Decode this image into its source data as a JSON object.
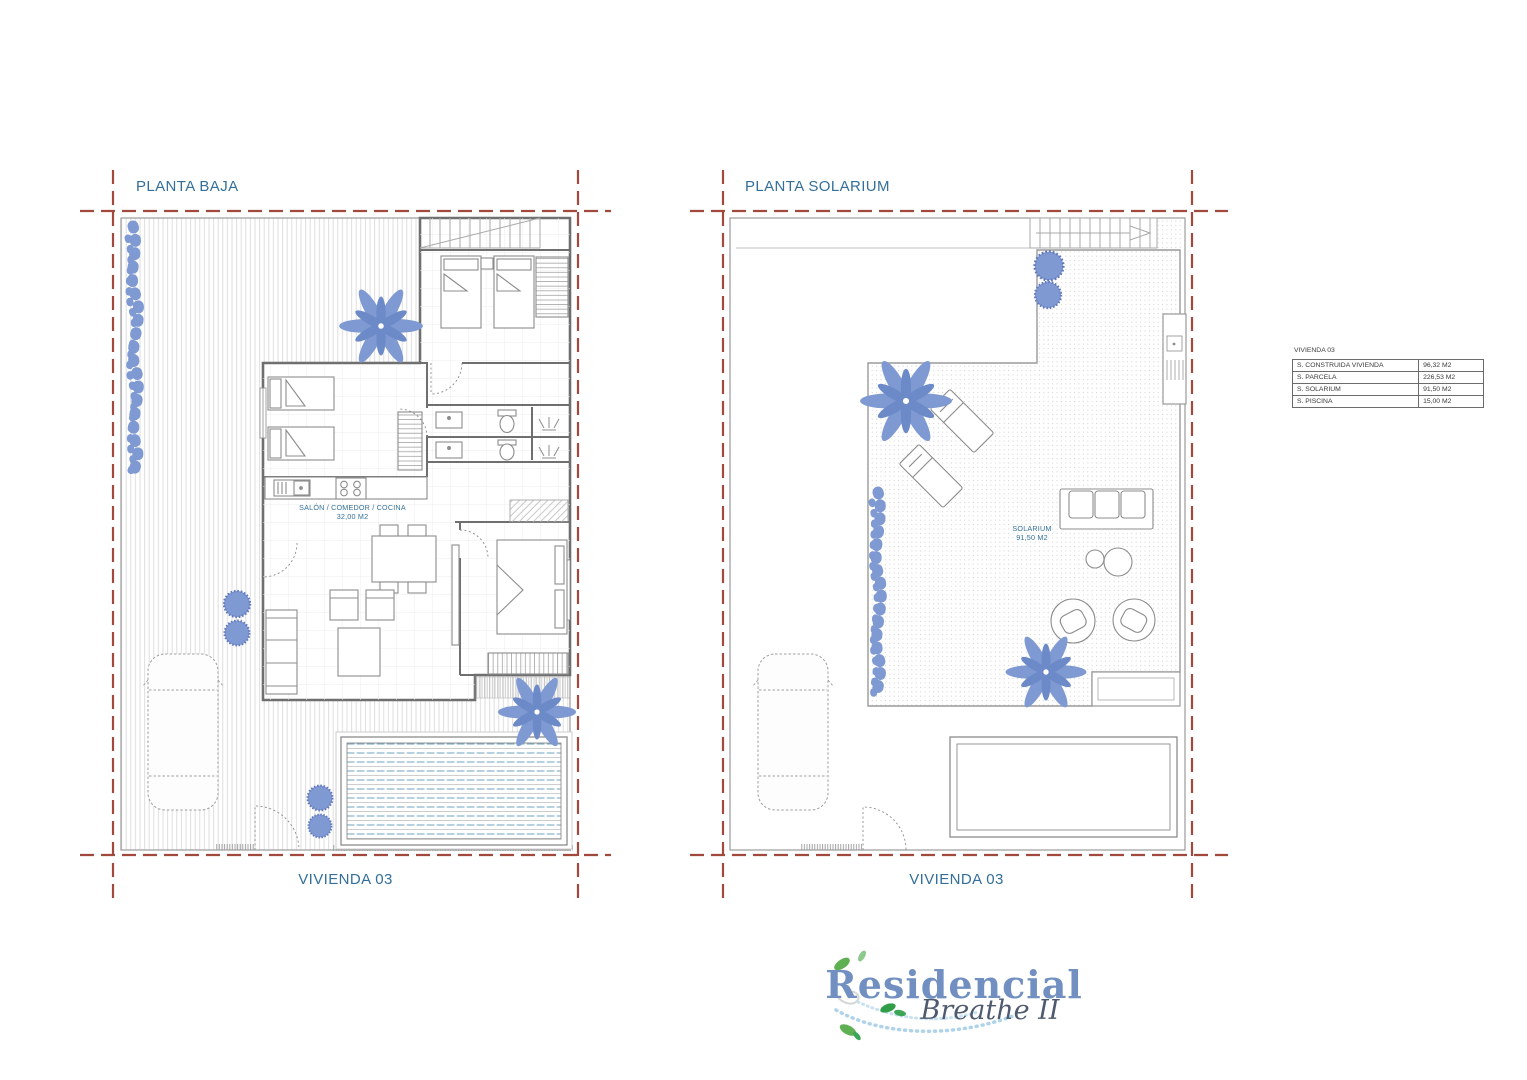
{
  "plans": [
    {
      "title": "PLANTA BAJA",
      "footer": "VIVIENDA 03",
      "room_label": {
        "name": "SALÓN / COMEDOR / COCINA",
        "area": "32,00 M2"
      }
    },
    {
      "title": "PLANTA SOLARIUM",
      "footer": "VIVIENDA 03",
      "room_label": {
        "name": "SOLARIUM",
        "area": "91,50 M2"
      }
    }
  ],
  "summary_table": {
    "title": "VIVIENDA 03",
    "rows": [
      {
        "label": "S. CONSTRUIDA VIVIENDA",
        "value": "96,32 M2"
      },
      {
        "label": "S. PARCELA",
        "value": "226,53 M2"
      },
      {
        "label": "S. SOLARIUM",
        "value": "91,50 M2"
      },
      {
        "label": "S. PISCINA",
        "value": "15,00 M2"
      }
    ]
  },
  "logo": {
    "name": "Residencial",
    "tagline": "Breathe II"
  },
  "colors": {
    "title_blue": "#336f9a",
    "drawing_gray": "#9a9a9a",
    "wall_gray": "#6f6f6f",
    "boundary_red": "#a1493d",
    "vegetation_blue": "#7f9ad2",
    "pool_blue": "#6fa5bd",
    "logo_blue": "#7190c1",
    "logo_script": "#4e5a6e",
    "leaf_green": "#5fb053"
  }
}
